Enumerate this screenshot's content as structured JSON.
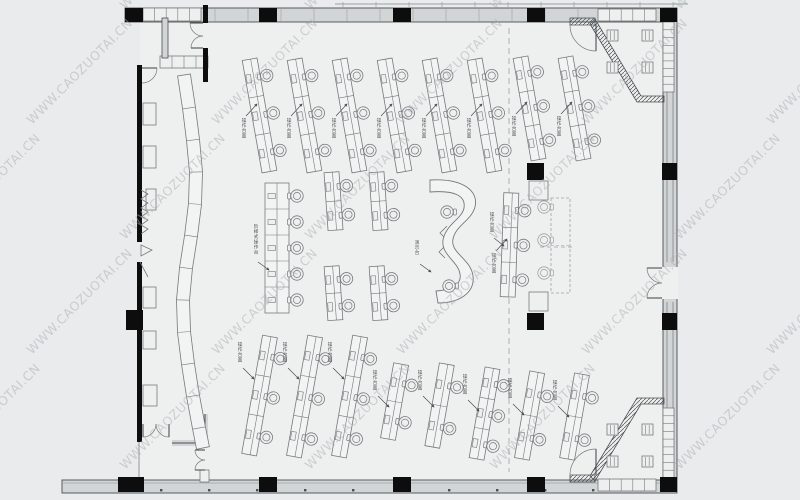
{
  "watermark": {
    "text": "WWW.CAOZUOTAI.CN",
    "color": "#a8adb0",
    "opacity": 0.5,
    "font_size": 12.5,
    "rotation": -45,
    "grid": {
      "rows": 5,
      "cols": 6,
      "x_start": -60,
      "x_step": 185,
      "y_start": 10,
      "y_step": 115,
      "row_offset": 92
    }
  },
  "palette": {
    "bg": "#e9ebec",
    "floor": "#eef0f0",
    "desk_fill": "#f2f3f3",
    "wall_fill": "#d2d5d6",
    "line": "#75797c",
    "dark": "#4a4f52",
    "black": "#0d0d0d",
    "light": "#9aa0a3",
    "label": "#4f5356"
  },
  "labels": {
    "row": "操作台面",
    "long": "阶梯式操作台",
    "wave": "演示台",
    "side": "操作台面"
  },
  "structure": {
    "floor": {
      "x": 140,
      "y": 20,
      "w": 525,
      "h": 460
    },
    "wall_bands": [
      {
        "x": 125,
        "y": 8,
        "w": 552,
        "h": 14
      },
      {
        "x": 62,
        "y": 480,
        "w": 615,
        "h": 13
      },
      {
        "x": 663,
        "y": 8,
        "w": 14,
        "h": 472
      }
    ],
    "right_door_gap": {
      "x": 662,
      "y": 267,
      "w": 16,
      "h": 32
    },
    "black_walls": [
      {
        "x": 137,
        "y": 65,
        "w": 5,
        "h": 177
      },
      {
        "x": 137,
        "y": 262,
        "w": 5,
        "h": 48
      },
      {
        "x": 126,
        "y": 310,
        "w": 17,
        "h": 20
      },
      {
        "x": 137,
        "y": 330,
        "w": 5,
        "h": 112
      },
      {
        "x": 203,
        "y": 5,
        "w": 5,
        "h": 18
      },
      {
        "x": 203,
        "y": 48,
        "w": 5,
        "h": 34
      }
    ],
    "gray_walls": [
      {
        "x": 162,
        "y": 18,
        "w": 6,
        "h": 40
      }
    ],
    "thin_lines": [
      {
        "x1": 139,
        "y1": 442,
        "x2": 139,
        "y2": 480
      },
      {
        "x1": 667,
        "y1": 30,
        "x2": 667,
        "y2": 262
      },
      {
        "x1": 667,
        "y1": 302,
        "x2": 667,
        "y2": 460
      },
      {
        "x1": 673,
        "y1": 30,
        "x2": 673,
        "y2": 262
      },
      {
        "x1": 673,
        "y1": 302,
        "x2": 673,
        "y2": 460
      }
    ],
    "l_wall_path": "M172,443 L205,443 L205,414",
    "columns": [
      {
        "x": 125,
        "y": 8,
        "w": 18,
        "h": 14
      },
      {
        "x": 259,
        "y": 8,
        "w": 18,
        "h": 14
      },
      {
        "x": 393,
        "y": 8,
        "w": 18,
        "h": 14
      },
      {
        "x": 527,
        "y": 8,
        "w": 18,
        "h": 14
      },
      {
        "x": 660,
        "y": 8,
        "w": 17,
        "h": 14
      },
      {
        "x": 118,
        "y": 477,
        "w": 26,
        "h": 15
      },
      {
        "x": 259,
        "y": 477,
        "w": 18,
        "h": 15
      },
      {
        "x": 393,
        "y": 477,
        "w": 18,
        "h": 15
      },
      {
        "x": 527,
        "y": 477,
        "w": 18,
        "h": 15
      },
      {
        "x": 660,
        "y": 477,
        "w": 17,
        "h": 15
      },
      {
        "x": 662,
        "y": 163,
        "w": 15,
        "h": 17
      },
      {
        "x": 662,
        "y": 313,
        "w": 15,
        "h": 17
      },
      {
        "x": 527,
        "y": 163,
        "w": 17,
        "h": 17
      },
      {
        "x": 527,
        "y": 313,
        "w": 17,
        "h": 17
      }
    ],
    "outline_boxes": [
      {
        "x": 529,
        "y": 181,
        "w": 19,
        "h": 19
      },
      {
        "x": 529,
        "y": 292,
        "w": 19,
        "h": 19
      },
      {
        "x": 143,
        "y": 103,
        "w": 13,
        "h": 22
      },
      {
        "x": 143,
        "y": 146,
        "w": 13,
        "h": 22
      },
      {
        "x": 146,
        "y": 189,
        "w": 10,
        "h": 21
      },
      {
        "x": 143,
        "y": 287,
        "w": 13,
        "h": 21
      },
      {
        "x": 143,
        "y": 331,
        "w": 13,
        "h": 18
      },
      {
        "x": 143,
        "y": 385,
        "w": 14,
        "h": 21
      },
      {
        "x": 200,
        "y": 470,
        "w": 9,
        "h": 12
      }
    ],
    "cabinet_rows": [
      {
        "x": 143,
        "y": 8,
        "w": 58,
        "h": 13,
        "cells": 5
      },
      {
        "x": 160,
        "y": 56,
        "w": 48,
        "h": 12,
        "cells": 4
      },
      {
        "x": 598,
        "y": 9,
        "w": 58,
        "h": 12,
        "cells": 5
      },
      {
        "x": 598,
        "y": 479,
        "w": 58,
        "h": 12,
        "cells": 5
      }
    ],
    "hatch_strips": [
      "590,24 595,19 641,96 664,96 664,102 637,102",
      "570,18 595,18 595,25 570,25",
      "590,476 595,481 641,404 664,404 664,398 637,398",
      "570,475 595,475 595,482 570,482"
    ],
    "ladders": [
      {
        "x": 663,
        "y": 22,
        "w": 11,
        "h": 70,
        "rungs": 9
      },
      {
        "x": 663,
        "y": 408,
        "w": 11,
        "h": 70,
        "rungs": 9
      }
    ],
    "squares": [
      {
        "x": 607,
        "y": 30
      },
      {
        "x": 642,
        "y": 30
      },
      {
        "x": 607,
        "y": 62
      },
      {
        "x": 642,
        "y": 62
      },
      {
        "x": 607,
        "y": 424
      },
      {
        "x": 642,
        "y": 424
      },
      {
        "x": 607,
        "y": 456
      },
      {
        "x": 642,
        "y": 456
      }
    ],
    "doors": [
      {
        "leaf": [
          142,
          68,
          157,
          68
        ],
        "arc": "M157,68 A15,15 0 0 1 142,83"
      },
      {
        "leaf": [
          203,
          23,
          190,
          23
        ],
        "arc": "M203,36 A13,13 0 0 1 190,23"
      },
      {
        "leaf": [
          203,
          48,
          191,
          48
        ],
        "arc": "M203,36 A12,12 0 0 0 191,48"
      },
      {
        "leaf": [
          662,
          268,
          647,
          268
        ],
        "arc": "M662,283 A15,15 0 0 1 647,268"
      },
      {
        "leaf": [
          662,
          298,
          647,
          298
        ],
        "arc": "M662,283 A15,15 0 0 0 647,298"
      },
      {
        "leaf": [
          596,
          24,
          596,
          51
        ],
        "arc": "M596,51 A26,26 0 0 1 570,25"
      },
      {
        "leaf": [
          596,
          449,
          596,
          475
        ],
        "arc": "M596,449 A26,26 0 0 0 570,475"
      },
      {
        "leaf": [
          143,
          424,
          143,
          437
        ],
        "arc": "M156,424 A13,13 0 0 1 143,437"
      },
      {
        "leaf": [
          169,
          424,
          169,
          437
        ],
        "arc": "M156,424 A13,13 0 0 0 169,437"
      },
      {
        "leaf": [
          205,
          450,
          195,
          450
        ],
        "arc": "M205,460 A10,10 0 0 1 195,450"
      },
      {
        "leaf": [
          205,
          470,
          195,
          470
        ],
        "arc": "M205,460 A10,10 0 0 0 195,470"
      }
    ],
    "curved_band": {
      "width": 13,
      "points": [
        [
          184,
          75
        ],
        [
          189,
          108
        ],
        [
          193,
          140
        ],
        [
          196,
          172
        ],
        [
          195,
          204
        ],
        [
          191,
          236
        ],
        [
          186,
          268
        ],
        [
          183,
          300
        ],
        [
          184,
          332
        ],
        [
          188,
          364
        ],
        [
          193,
          396
        ],
        [
          199,
          428
        ],
        [
          203,
          448
        ]
      ]
    },
    "extra_paths": [
      "M141,190 l7,4 -7,5 7,4 -7,5 7,4 -7,5",
      "M141,216 l7,4 -7,5 7,4 -7,5",
      "M141,245 L152,250 L141,256 Z",
      "M140,262 L148,277",
      "M447,226 l-7,7 7,7",
      "M445,246 l-6,6 6,6"
    ],
    "axis_line": {
      "x": 509,
      "y1": 28,
      "y2": 472
    },
    "dashed_extras": [
      {
        "x1": 540,
        "y1": 247,
        "x2": 572,
        "y2": 247
      }
    ],
    "parapet": {
      "x1": 335,
      "x2": 688,
      "y": 4,
      "step": 33,
      "tick_len": 5
    },
    "mullions": {
      "x1": 215,
      "x2": 655,
      "y1": 9,
      "y2": 21,
      "step": 33
    },
    "bottom_inner": {
      "x1": 62,
      "x2": 677,
      "y": 483
    },
    "bottom_dots": {
      "x1": 160,
      "x2": 660,
      "y": 489,
      "step": 48
    }
  },
  "furniture": {
    "top_rows": [
      {
        "cx": 262,
        "y": 58,
        "len": 114,
        "seats": 3,
        "rot": -10,
        "label": true
      },
      {
        "cx": 307,
        "y": 58,
        "len": 114,
        "seats": 3,
        "rot": -10,
        "label": true
      },
      {
        "cx": 352,
        "y": 58,
        "len": 114,
        "seats": 3,
        "rot": -10,
        "label": true
      },
      {
        "cx": 397,
        "y": 58,
        "len": 114,
        "seats": 3,
        "rot": -10,
        "label": true
      },
      {
        "cx": 442,
        "y": 58,
        "len": 114,
        "seats": 3,
        "rot": -10,
        "label": true
      },
      {
        "cx": 487,
        "y": 58,
        "len": 114,
        "seats": 3,
        "rot": -10,
        "label": true
      },
      {
        "cx": 532,
        "y": 56,
        "len": 104,
        "seats": 3,
        "rot": -10,
        "label": true
      },
      {
        "cx": 577,
        "y": 56,
        "len": 104,
        "seats": 3,
        "rot": -10,
        "label": true
      }
    ],
    "mid_desks": [
      {
        "cx": 336,
        "y": 172,
        "len": 58,
        "seats": 2,
        "rot": -4,
        "label": false
      },
      {
        "cx": 381,
        "y": 172,
        "len": 58,
        "seats": 2,
        "rot": -4,
        "label": false
      },
      {
        "cx": 336,
        "y": 266,
        "len": 54,
        "seats": 2,
        "rot": -4,
        "label": false
      },
      {
        "cx": 381,
        "y": 266,
        "len": 54,
        "seats": 2,
        "rot": -4,
        "label": false
      }
    ],
    "side_rows": [
      {
        "cx": 512,
        "y": 193,
        "len": 104,
        "seats": 3,
        "rot": 2,
        "label": true
      }
    ],
    "bottom_rows": [
      {
        "cx": 262,
        "y": 336,
        "len": 120,
        "seats": 3,
        "rot": 10,
        "label": true
      },
      {
        "cx": 307,
        "y": 336,
        "len": 122,
        "seats": 3,
        "rot": 10,
        "label": true
      },
      {
        "cx": 352,
        "y": 336,
        "len": 122,
        "seats": 3,
        "rot": 10,
        "label": true
      },
      {
        "cx": 397,
        "y": 364,
        "len": 76,
        "seats": 2,
        "rot": 10,
        "label": true
      },
      {
        "cx": 442,
        "y": 364,
        "len": 84,
        "seats": 2,
        "rot": 10,
        "label": true
      },
      {
        "cx": 487,
        "y": 368,
        "len": 92,
        "seats": 3,
        "rot": 10,
        "label": true
      },
      {
        "cx": 532,
        "y": 372,
        "len": 88,
        "seats": 2,
        "rot": 10,
        "label": true
      },
      {
        "cx": 577,
        "y": 374,
        "len": 86,
        "seats": 2,
        "rot": 10,
        "label": true
      }
    ],
    "long_desk": {
      "x": 265,
      "y": 183,
      "w": 24,
      "h": 130,
      "seats": 5,
      "chair_x": 297,
      "label_x": 256,
      "label_y": 228,
      "arrow": [
        258,
        262,
        269,
        270
      ]
    },
    "reserved_desk": {
      "x": 551,
      "y": 198,
      "w": 19,
      "h": 95,
      "chairs": [
        [
          544,
          207
        ],
        [
          544,
          240
        ],
        [
          544,
          273
        ]
      ]
    },
    "wave_desk": {
      "path": "M430,180 C463,178 479,191 475,207 C471,221 456,225 453,239 C450,253 471,259 473,276 C475,293 459,303 438,303 L436,291 C452,290 462,284 460,274 C458,261 441,255 443,240 C446,224 462,219 464,208 C466,196 455,190 430,192 Z",
      "chairs": [
        [
          447,
          212
        ],
        [
          449,
          286
        ]
      ],
      "label_x": 417,
      "label_y": 244,
      "arrow": [
        420,
        264,
        431,
        272
      ]
    }
  }
}
